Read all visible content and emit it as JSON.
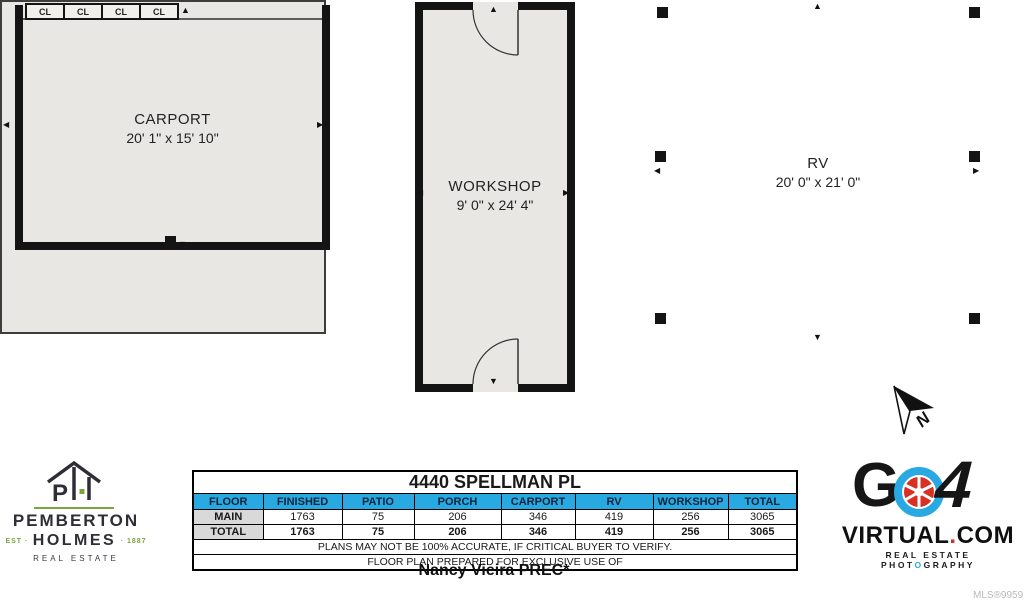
{
  "plan": {
    "carport": {
      "name": "CARPORT",
      "dims": "20' 1\" x 15' 10\"",
      "closets": [
        "CL",
        "CL",
        "CL",
        "CL"
      ]
    },
    "workshop": {
      "name": "WORKSHOP",
      "dims": "9' 0\" x 24' 4\""
    },
    "rv": {
      "name": "RV",
      "dims": "20' 0\" x 21' 0\""
    },
    "north_label": "N"
  },
  "icons": {
    "triangle_up": "▲",
    "triangle_down": "▼",
    "triangle_left": "◀",
    "triangle_right": "▶"
  },
  "table": {
    "title": "4440 SPELLMAN PL",
    "headers": [
      "FLOOR",
      "FINISHED",
      "PATIO",
      "PORCH",
      "CARPORT",
      "RV",
      "WORKSHOP",
      "TOTAL"
    ],
    "rows": [
      {
        "floor": "MAIN",
        "values": [
          "1763",
          "75",
          "206",
          "346",
          "419",
          "256",
          "3065"
        ]
      },
      {
        "floor": "TOTAL",
        "values": [
          "1763",
          "75",
          "206",
          "346",
          "419",
          "256",
          "3065"
        ]
      }
    ],
    "note1": "PLANS MAY NOT BE 100% ACCURATE, IF CRITICAL BUYER TO VERIFY.",
    "note2": "FLOOR PLAN PREPARED FOR EXCLUSIVE USE OF",
    "prepared_for": "Nancy Vieira PREC*"
  },
  "branding": {
    "pemberton": {
      "monogram_p": "P",
      "line1": "PEMBERTON",
      "est": "EST ·",
      "holmes": "HOLMES",
      "year": "· 1887",
      "line3": "REAL ESTATE"
    },
    "go4": {
      "g": "G",
      "four": "4",
      "domain_part1": "VIRTUAL",
      "domain_dot": ".",
      "domain_part2": "COM",
      "tagline_part1": "REAL ESTATE PHOT",
      "tagline_o": "O",
      "tagline_part2": "GRAPHY"
    },
    "mls": "MLS®995916"
  },
  "colors": {
    "header_blue": "#29a9e1",
    "wall_black": "#141414",
    "floor_fill": "#e8e7e4",
    "row_label_gray": "#d9d9d9",
    "brand_green": "#7aa43c",
    "brand_red": "#d93025",
    "brand_blue": "#29a9e1"
  }
}
